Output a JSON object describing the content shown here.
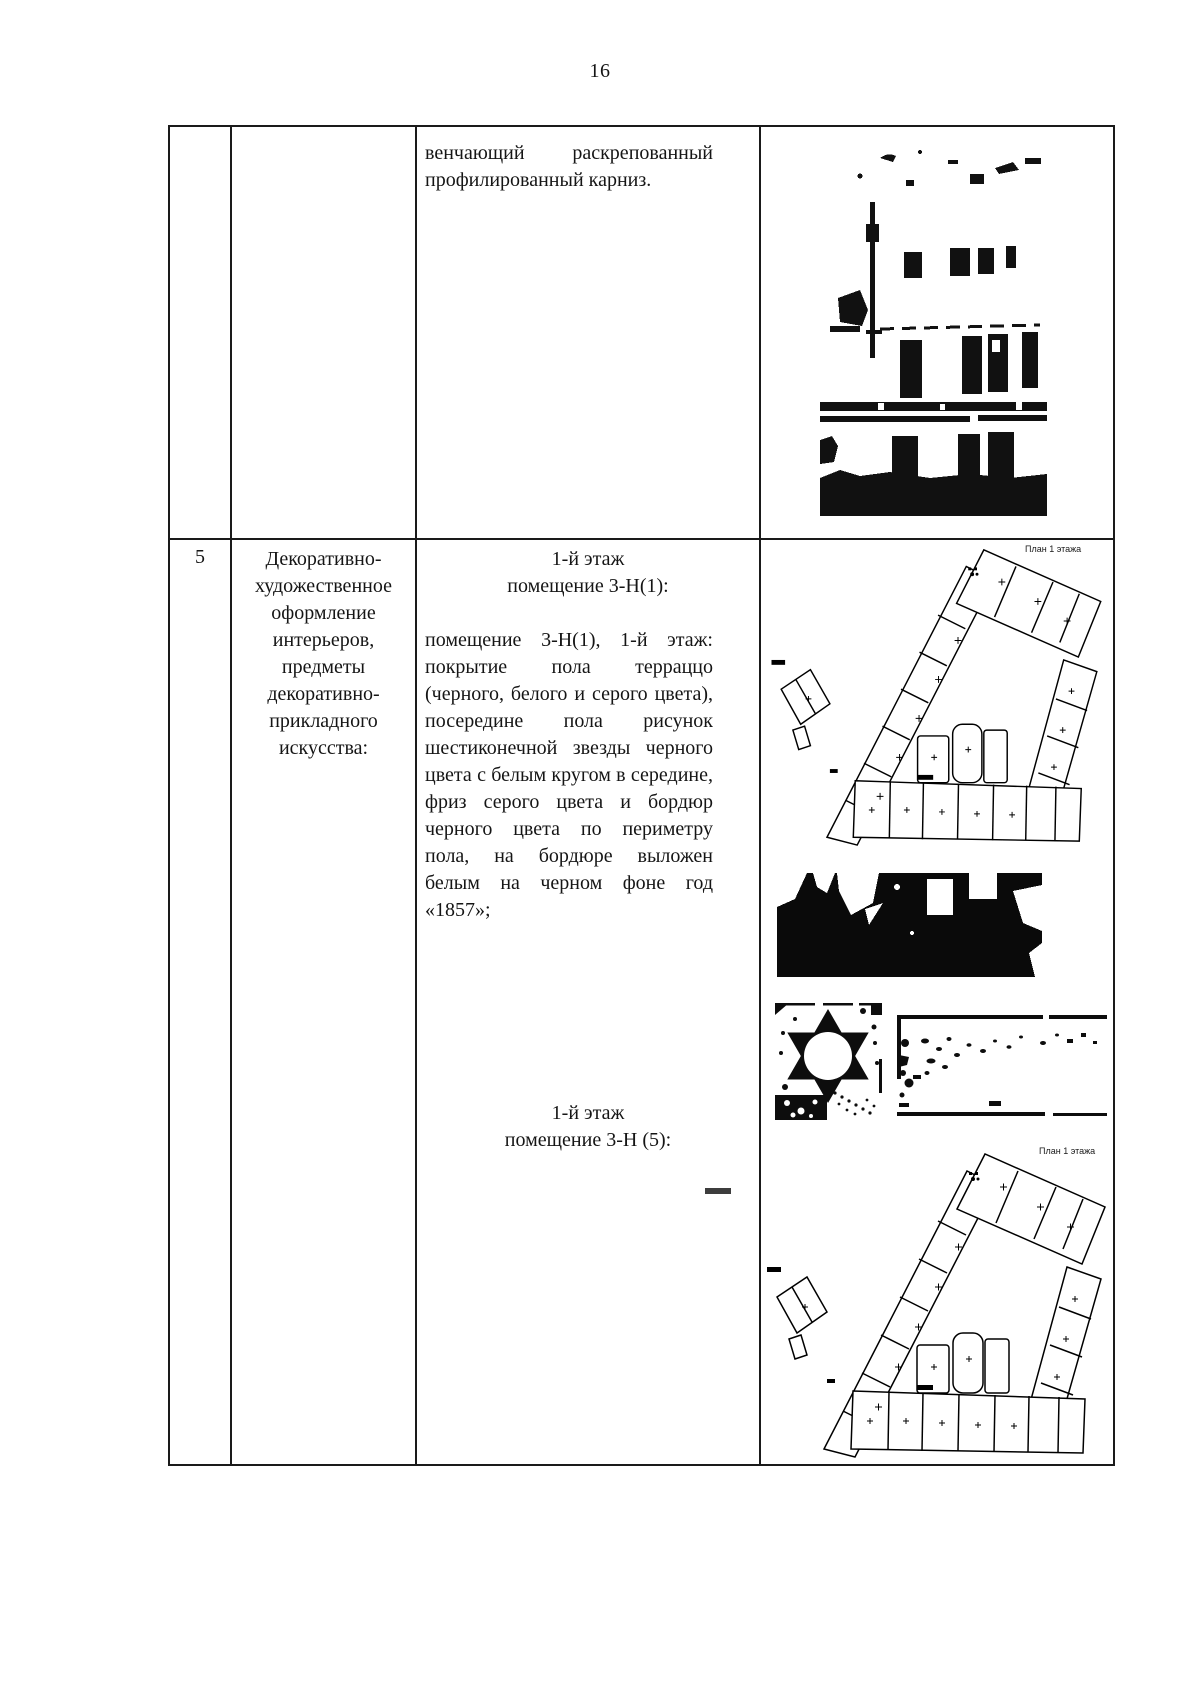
{
  "page_number": "16",
  "colors": {
    "ink": "#1a1a1a",
    "paper": "#ffffff"
  },
  "row1": {
    "text": "венчающий раскрепованный профилированный карниз.",
    "image_name": "building-facade-photo"
  },
  "row2": {
    "num": "5",
    "category_lines": [
      "Декоративно-",
      "художественное",
      "оформление",
      "интерьеров,",
      "предметы",
      "декоративно-",
      "прикладного",
      "искусства:"
    ],
    "head1_line1": "1-й этаж",
    "head1_line2": "помещение 3-Н(1):",
    "paragraph": "помещение 3-Н(1), 1-й этаж: покрытие пола терраццо (черного, белого и серого цвета), посередине пола рисунок шестиконечной звезды черного цвета с белым кругом в середине, фриз серого цвета и бордюр черного цвета по периметру пола, на бордюре выложен белым на черном фоне год «1857»;",
    "head2_line1": "1-й этаж",
    "head2_line2": "помещение 3-Н (5):",
    "plan1_label": "План 1 этажа",
    "plan2_label": "План 1 этажа",
    "image_names": [
      "floor-plan-1",
      "interior-floor-photo",
      "star-floor-tile-photo",
      "floor-border-year-photo",
      "floor-plan-2"
    ]
  }
}
